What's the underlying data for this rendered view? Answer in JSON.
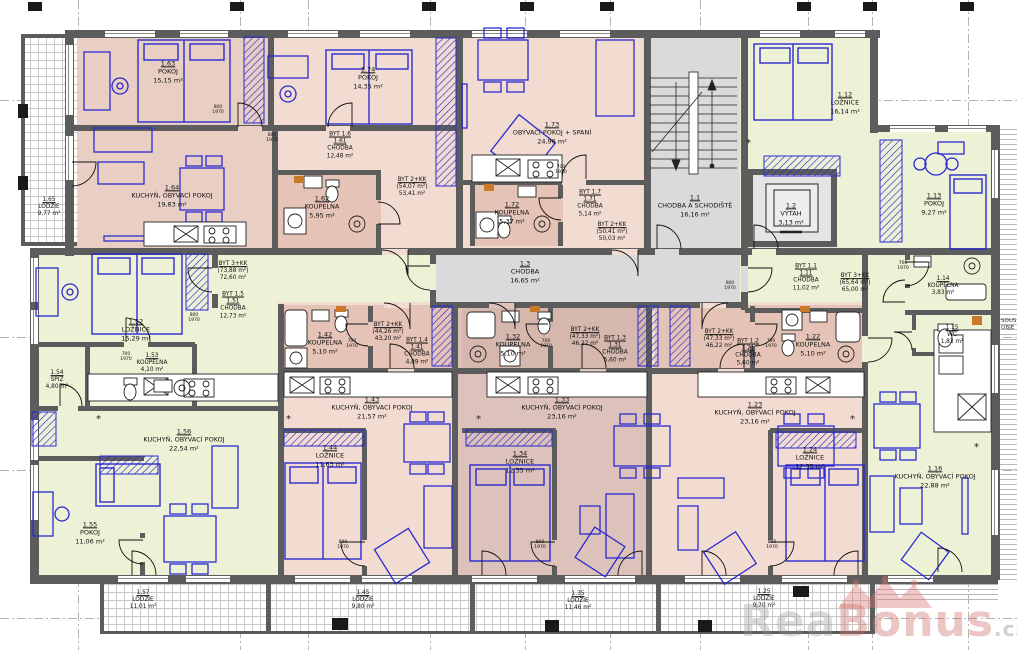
{
  "palette": {
    "wall": "#5c5c5c",
    "pink_a": "#e9cfc3",
    "pink_b": "#f2dcd1",
    "pink_dark": "#e5c3b6",
    "mauve": "#dcc2ba",
    "mauve_dark": "#d5b7ae",
    "green": "#edf2d6",
    "gray": "#dadada",
    "gray_dark": "#e4e4e4",
    "blue": "#2b2bd0",
    "orange": "#c87a2a",
    "white": "#ffffff"
  },
  "watermark": {
    "rea": "Rea",
    "bonus": "Bonus",
    "cz": ".cz"
  },
  "side_note": {
    "line1": "SOUS",
    "line2": "OBJE"
  },
  "labels": [
    {
      "x": 49,
      "y": 208,
      "small": 1,
      "lines": [
        [
          "1.65",
          1
        ],
        [
          "LODŽIE",
          0
        ],
        [
          "9,77 m²",
          0
        ]
      ]
    },
    {
      "x": 168,
      "y": 72,
      "small": 0,
      "lines": [
        [
          "1.63",
          1
        ],
        [
          "POKOJ",
          0
        ],
        [
          "15,15 m²",
          0
        ]
      ]
    },
    {
      "x": 172,
      "y": 196,
      "small": 0,
      "lines": [
        [
          "1.64",
          1
        ],
        [
          "KUCHYŇ, OBÝVACÍ POKOJ",
          0
        ],
        [
          "19,83 m²",
          0
        ]
      ]
    },
    {
      "x": 368,
      "y": 78,
      "small": 0,
      "lines": [
        [
          "1.74",
          1
        ],
        [
          "POKOJ",
          0
        ],
        [
          "14,35 m²",
          0
        ]
      ]
    },
    {
      "x": 322,
      "y": 207,
      "small": 0,
      "lines": [
        [
          "1.62",
          1
        ],
        [
          "KOUPELNA",
          0
        ],
        [
          "5,95 m²",
          0
        ]
      ]
    },
    {
      "x": 552,
      "y": 133,
      "small": 0,
      "lines": [
        [
          "1.73",
          1
        ],
        [
          "OBÝVACÍ POKOJ + SPANÍ",
          0
        ],
        [
          "24,96 m²",
          0
        ]
      ]
    },
    {
      "x": 512,
      "y": 213,
      "small": 0,
      "lines": [
        [
          "1.72",
          1
        ],
        [
          "KOUPELNA",
          0
        ],
        [
          "5,37 m²",
          0
        ]
      ]
    },
    {
      "x": 695,
      "y": 206,
      "small": 0,
      "lines": [
        [
          "1.1",
          1
        ],
        [
          "CHODBA A SCHODIŠTĚ",
          0
        ],
        [
          "16,16 m²",
          0
        ]
      ]
    },
    {
      "x": 791,
      "y": 214,
      "small": 0,
      "lines": [
        [
          "1.2",
          1
        ],
        [
          "VÝTAH",
          0
        ],
        [
          "3,13 m²",
          0
        ]
      ]
    },
    {
      "x": 845,
      "y": 103,
      "small": 0,
      "lines": [
        [
          "1.12",
          1
        ],
        [
          "LOŽNICE",
          0
        ],
        [
          "16,14 m²",
          0
        ]
      ]
    },
    {
      "x": 934,
      "y": 204,
      "small": 0,
      "lines": [
        [
          "1.13",
          1
        ],
        [
          "POKOJ",
          0
        ],
        [
          "9,27 m²",
          0
        ]
      ]
    },
    {
      "x": 943,
      "y": 287,
      "small": 1,
      "lines": [
        [
          "1.14",
          1
        ],
        [
          "KOUPELNA",
          0
        ],
        [
          "3,83 m²",
          0
        ]
      ]
    },
    {
      "x": 952,
      "y": 336,
      "small": 1,
      "lines": [
        [
          "1.15",
          1
        ],
        [
          "WC",
          0
        ],
        [
          "1,83 m²",
          0
        ]
      ]
    },
    {
      "x": 136,
      "y": 330,
      "small": 0,
      "lines": [
        [
          "1.52",
          1
        ],
        [
          "LOŽNICE",
          0
        ],
        [
          "15,29 m²",
          0
        ]
      ]
    },
    {
      "x": 152,
      "y": 364,
      "small": 1,
      "lines": [
        [
          "1.53",
          1
        ],
        [
          "KOUPELNA",
          0
        ],
        [
          "4,10 m²",
          0
        ]
      ]
    },
    {
      "x": 57,
      "y": 381,
      "small": 1,
      "lines": [
        [
          "1.54",
          1
        ],
        [
          "SPÍŽ",
          0
        ],
        [
          "4,80 m²",
          0
        ]
      ]
    },
    {
      "x": 184,
      "y": 440,
      "small": 0,
      "lines": [
        [
          "1.56",
          1
        ],
        [
          "KUCHYŇ, OBÝVACÍ POKOJ",
          0
        ],
        [
          "22,54 m²",
          0
        ]
      ]
    },
    {
      "x": 90,
      "y": 533,
      "small": 0,
      "lines": [
        [
          "1.55",
          1
        ],
        [
          "POKOJ",
          0
        ],
        [
          "11,06 m²",
          0
        ]
      ]
    },
    {
      "x": 325,
      "y": 343,
      "small": 0,
      "lines": [
        [
          "1.42",
          1
        ],
        [
          "KOUPELNA",
          0
        ],
        [
          "5,10 m²",
          0
        ]
      ]
    },
    {
      "x": 372,
      "y": 408,
      "small": 0,
      "lines": [
        [
          "1.43",
          1
        ],
        [
          "KUCHYŇ, OBÝVACÍ POKOJ",
          0
        ],
        [
          "21,57 m²",
          0
        ]
      ]
    },
    {
      "x": 330,
      "y": 456,
      "small": 0,
      "lines": [
        [
          "1.44",
          1
        ],
        [
          "LOŽNICE",
          0
        ],
        [
          "11,63 m²",
          0
        ]
      ]
    },
    {
      "x": 513,
      "y": 345,
      "small": 0,
      "lines": [
        [
          "1.32",
          1
        ],
        [
          "KOUPELNA",
          0
        ],
        [
          "5,10 m²",
          0
        ]
      ]
    },
    {
      "x": 562,
      "y": 408,
      "small": 0,
      "lines": [
        [
          "1.33",
          1
        ],
        [
          "KUCHYŇ, OBÝVACÍ POKOJ",
          0
        ],
        [
          "23,16 m²",
          0
        ]
      ]
    },
    {
      "x": 520,
      "y": 462,
      "small": 0,
      "lines": [
        [
          "1.34",
          1
        ],
        [
          "LOŽNICE",
          0
        ],
        [
          "12,35 m²",
          0
        ]
      ]
    },
    {
      "x": 813,
      "y": 345,
      "small": 0,
      "lines": [
        [
          "1.22",
          1
        ],
        [
          "KOUPELNA",
          0
        ],
        [
          "5,10 m²",
          0
        ]
      ]
    },
    {
      "x": 755,
      "y": 413,
      "small": 0,
      "lines": [
        [
          "1.23",
          1
        ],
        [
          "KUCHYŇ, OBÝVACÍ POKOJ",
          0
        ],
        [
          "23,16 m²",
          0
        ]
      ]
    },
    {
      "x": 810,
      "y": 458,
      "small": 0,
      "lines": [
        [
          "1.24",
          1
        ],
        [
          "LOŽNICE",
          0
        ],
        [
          "12,35 m²",
          0
        ]
      ]
    },
    {
      "x": 935,
      "y": 477,
      "small": 0,
      "lines": [
        [
          "1.16",
          1
        ],
        [
          "KUCHYŇ, OBÝVACÍ POKOJ",
          0
        ],
        [
          "22,88 m²",
          0
        ]
      ]
    },
    {
      "x": 525,
      "y": 272,
      "small": 0,
      "lines": [
        [
          "1.3",
          1
        ],
        [
          "CHODBA",
          0
        ],
        [
          "16,65 m²",
          0
        ]
      ]
    },
    {
      "x": 143,
      "y": 601,
      "small": 1,
      "lines": [
        [
          "1.57",
          1
        ],
        [
          "LODŽIE",
          0
        ],
        [
          "11,01 m²",
          0
        ]
      ]
    },
    {
      "x": 363,
      "y": 601,
      "small": 1,
      "lines": [
        [
          "1.45",
          1
        ],
        [
          "LODŽIE",
          0
        ],
        [
          "9,80 m²",
          0
        ]
      ]
    },
    {
      "x": 578,
      "y": 602,
      "small": 1,
      "lines": [
        [
          "1.35",
          1
        ],
        [
          "LODŽIE",
          0
        ],
        [
          "11,46 m²",
          0
        ]
      ]
    },
    {
      "x": 764,
      "y": 600,
      "small": 1,
      "lines": [
        [
          "1.25",
          1
        ],
        [
          "LODŽIE",
          0
        ],
        [
          "9,70 m²",
          0
        ]
      ]
    },
    {
      "x": 340,
      "y": 146,
      "small": 1,
      "lines": [
        [
          "BYT 1.6",
          1
        ],
        [
          "1.61",
          1
        ],
        [
          "CHODBA",
          0
        ],
        [
          "12,48 m²",
          0
        ]
      ]
    },
    {
      "x": 412,
      "y": 188,
      "small": 1,
      "lines": [
        [
          "BYT 2+KK",
          1
        ],
        [
          "(54,07 m²)",
          0
        ],
        [
          "53,41 m²",
          0
        ]
      ]
    },
    {
      "x": 590,
      "y": 204,
      "small": 1,
      "lines": [
        [
          "BYT 1.7",
          1
        ],
        [
          "1.71",
          1
        ],
        [
          "CHODBA",
          0
        ],
        [
          "5,14 m²",
          0
        ]
      ]
    },
    {
      "x": 612,
      "y": 233,
      "small": 1,
      "lines": [
        [
          "BYT 2+KK",
          1
        ],
        [
          "(50,41 m²)",
          0
        ],
        [
          "50,03 m²",
          0
        ]
      ]
    },
    {
      "x": 806,
      "y": 278,
      "small": 1,
      "lines": [
        [
          "BYT 1.1",
          1
        ],
        [
          "1.11",
          1
        ],
        [
          "CHODBA",
          0
        ],
        [
          "11,02 m²",
          0
        ]
      ]
    },
    {
      "x": 855,
      "y": 284,
      "small": 1,
      "lines": [
        [
          "BYT 3+KK",
          1
        ],
        [
          "(65,64 m²)",
          0
        ],
        [
          "65,00 m²",
          0
        ]
      ]
    },
    {
      "x": 233,
      "y": 272,
      "small": 1,
      "lines": [
        [
          "BYT 3+KK",
          1
        ],
        [
          "(73,88 m²)",
          0
        ],
        [
          "72,60 m²",
          0
        ]
      ]
    },
    {
      "x": 233,
      "y": 306,
      "small": 1,
      "lines": [
        [
          "BYT 1.5",
          1
        ],
        [
          "1.51",
          1
        ],
        [
          "CHODBA",
          0
        ],
        [
          "12,73 m²",
          0
        ]
      ]
    },
    {
      "x": 388,
      "y": 333,
      "small": 1,
      "lines": [
        [
          "BYT 2+KK",
          1
        ],
        [
          "(44,26 m²)",
          0
        ],
        [
          "43,20 m²",
          0
        ]
      ]
    },
    {
      "x": 417,
      "y": 352,
      "small": 1,
      "lines": [
        [
          "BYT 1.4",
          1
        ],
        [
          "1.41",
          1
        ],
        [
          "CHODBA",
          0
        ],
        [
          "4,89 m²",
          0
        ]
      ]
    },
    {
      "x": 585,
      "y": 338,
      "small": 1,
      "lines": [
        [
          "BYT 2+KK",
          1
        ],
        [
          "(47,33 m²)",
          0
        ],
        [
          "46,22 m²",
          0
        ]
      ]
    },
    {
      "x": 615,
      "y": 350,
      "small": 1,
      "lines": [
        [
          "BYT 1.3",
          1
        ],
        [
          "1.31",
          1
        ],
        [
          "CHODBA",
          0
        ],
        [
          "5,60 m²",
          0
        ]
      ]
    },
    {
      "x": 719,
      "y": 340,
      "small": 1,
      "lines": [
        [
          "BYT 2+KK",
          1
        ],
        [
          "(47,33 m²)",
          0
        ],
        [
          "46,22 m²",
          0
        ]
      ]
    },
    {
      "x": 748,
      "y": 353,
      "small": 1,
      "lines": [
        [
          "BYT 1.2",
          1
        ],
        [
          "1.21",
          1
        ],
        [
          "CHODBA",
          0
        ],
        [
          "5,60 m²",
          0
        ]
      ]
    }
  ],
  "door_tags": [
    {
      "x": 218,
      "y": 110,
      "a": "800",
      "b": "1970"
    },
    {
      "x": 272,
      "y": 138,
      "a": "800",
      "b": "1970"
    },
    {
      "x": 561,
      "y": 170,
      "a": "700",
      "b": "1970"
    },
    {
      "x": 194,
      "y": 318,
      "a": "800",
      "b": "1970"
    },
    {
      "x": 352,
      "y": 344,
      "a": "700",
      "b": "1970"
    },
    {
      "x": 546,
      "y": 344,
      "a": "700",
      "b": "1970"
    },
    {
      "x": 771,
      "y": 344,
      "a": "700",
      "b": "1970"
    },
    {
      "x": 343,
      "y": 545,
      "a": "800",
      "b": "1970"
    },
    {
      "x": 540,
      "y": 545,
      "a": "800",
      "b": "1970"
    },
    {
      "x": 772,
      "y": 545,
      "a": "800",
      "b": "1970"
    },
    {
      "x": 126,
      "y": 357,
      "a": "700",
      "b": "1970"
    },
    {
      "x": 903,
      "y": 266,
      "a": "700",
      "b": "1970"
    },
    {
      "x": 730,
      "y": 286,
      "a": "900",
      "b": "1970"
    }
  ]
}
